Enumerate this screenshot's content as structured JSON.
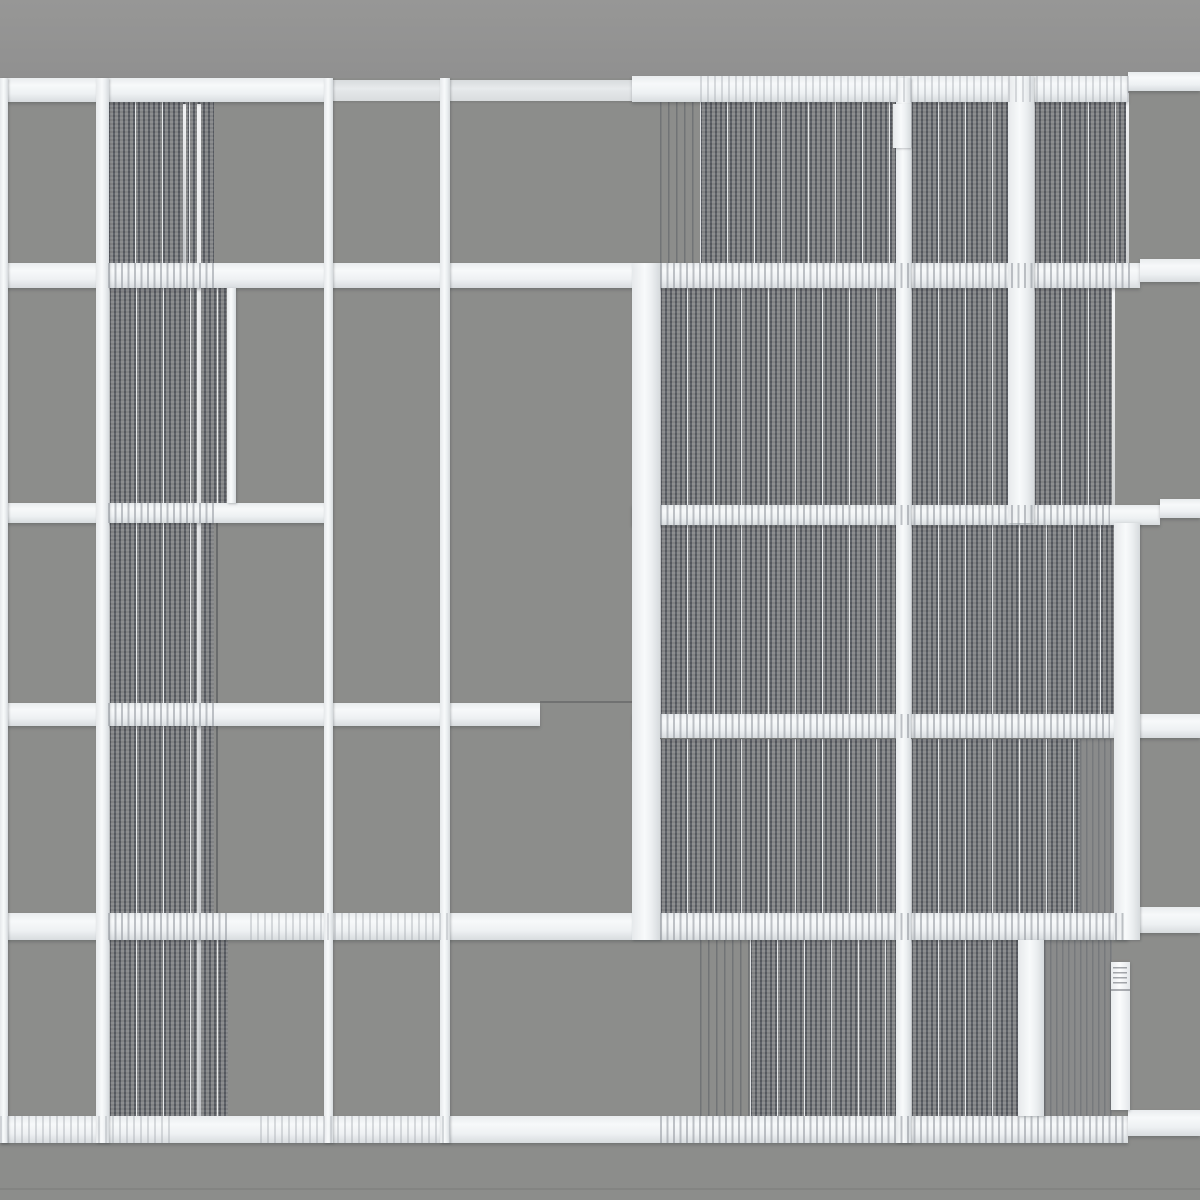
{
  "artwork": {
    "description": "photograph of abstract thread-and-wood wall artwork, no text",
    "canvas": {
      "width": 1200,
      "height": 1200
    },
    "palette": {
      "wall_gray": "#8c8d8b",
      "sky_gray": "#969695",
      "bar_white": "#f7f9fa",
      "bar_shade": "#d8dcdf",
      "thread_dark": "#50545b",
      "thread_mid": "#8c8f94",
      "warp_white": "#f7f9fa",
      "shadow": "#3c3e42"
    },
    "elements": [
      {
        "name": "sky-band",
        "style": "sky",
        "x": 0,
        "y": 0,
        "w": 1200,
        "h": 78
      },
      {
        "name": "panel-r1-left",
        "style": "threads-dense",
        "x": 108,
        "y": 102,
        "w": 106,
        "h": 161
      },
      {
        "name": "panel-r1-mid-sparse",
        "style": "threads-sparse",
        "x": 660,
        "y": 102,
        "w": 42,
        "h": 161
      },
      {
        "name": "panel-r1-mid",
        "style": "threads-dense",
        "x": 700,
        "y": 102,
        "w": 196,
        "h": 161
      },
      {
        "name": "panel-r1-right",
        "style": "threads-dense",
        "x": 911,
        "y": 102,
        "w": 97,
        "h": 161
      },
      {
        "name": "panel-r1-far",
        "style": "threads-dense",
        "x": 1034,
        "y": 102,
        "w": 92,
        "h": 161
      },
      {
        "name": "panel-r2-left",
        "style": "threads-dense",
        "x": 109,
        "y": 288,
        "w": 118,
        "h": 215
      },
      {
        "name": "panel-r2-mid",
        "style": "threads-dense",
        "x": 660,
        "y": 288,
        "w": 236,
        "h": 217
      },
      {
        "name": "panel-r2-right",
        "style": "threads-dense",
        "x": 911,
        "y": 288,
        "w": 97,
        "h": 217
      },
      {
        "name": "panel-r2-far",
        "style": "threads-dense",
        "x": 1034,
        "y": 288,
        "w": 78,
        "h": 217
      },
      {
        "name": "panel-r3-left",
        "style": "threads-dense",
        "x": 109,
        "y": 523,
        "w": 105,
        "h": 180
      },
      {
        "name": "panel-r3-mid",
        "style": "threads-dense",
        "x": 660,
        "y": 523,
        "w": 236,
        "h": 191
      },
      {
        "name": "panel-r3-right",
        "style": "threads-dense",
        "x": 911,
        "y": 523,
        "w": 203,
        "h": 191
      },
      {
        "name": "panel-r4-left",
        "style": "threads-dense",
        "x": 109,
        "y": 726,
        "w": 105,
        "h": 187
      },
      {
        "name": "panel-r4-mid",
        "style": "threads-dense",
        "x": 660,
        "y": 739,
        "w": 236,
        "h": 174
      },
      {
        "name": "panel-r4-right",
        "style": "threads-dense",
        "x": 911,
        "y": 739,
        "w": 169,
        "h": 174
      },
      {
        "name": "panel-r4-far-light",
        "style": "threads-light",
        "x": 1080,
        "y": 739,
        "w": 34,
        "h": 174
      },
      {
        "name": "panel-r5-left",
        "style": "threads-dense",
        "x": 109,
        "y": 940,
        "w": 119,
        "h": 176
      },
      {
        "name": "panel-r5-mid-sparse",
        "style": "threads-sparse",
        "x": 700,
        "y": 940,
        "w": 50,
        "h": 176
      },
      {
        "name": "panel-r5-mid",
        "style": "threads-dense",
        "x": 750,
        "y": 940,
        "w": 146,
        "h": 176
      },
      {
        "name": "panel-r5-right",
        "style": "threads-dense",
        "x": 911,
        "y": 940,
        "w": 107,
        "h": 176
      },
      {
        "name": "panel-r5-far-light",
        "style": "threads-light",
        "x": 1044,
        "y": 940,
        "w": 68,
        "h": 176
      },
      {
        "name": "warp-line-left-panel",
        "style": "warp-line",
        "x": 197,
        "y": 104,
        "w": 4,
        "h": 1012
      },
      {
        "name": "warp-line-row1-left",
        "style": "warp-line",
        "x": 183,
        "y": 104,
        "w": 3,
        "h": 159
      },
      {
        "name": "warp-line-row1-right-edge",
        "style": "warp-line",
        "x": 1126,
        "y": 93,
        "w": 3,
        "h": 172
      },
      {
        "name": "warp-line-row2-right-edge",
        "style": "warp-line",
        "x": 1112,
        "y": 288,
        "w": 3,
        "h": 217
      },
      {
        "name": "dark-thread-line",
        "style": "dark-line",
        "x": 216,
        "y": 523,
        "w": 2,
        "h": 390
      },
      {
        "name": "seam-h4-gap",
        "style": "shadow-seam",
        "x": 540,
        "y": 701,
        "w": 94,
        "h": 2
      },
      {
        "name": "seam-wall-bottom",
        "style": "wall-seam",
        "x": 0,
        "y": 1188,
        "w": 1200,
        "h": 2
      },
      {
        "name": "bar-h1-left",
        "style": "bar-h",
        "x": 0,
        "y": 78,
        "w": 330,
        "h": 24
      },
      {
        "name": "bar-h1-middle",
        "style": "bar-h-dim",
        "x": 330,
        "y": 80,
        "w": 302,
        "h": 21
      },
      {
        "name": "bar-h1-right",
        "style": "bar-h",
        "x": 632,
        "y": 76,
        "w": 496,
        "h": 26
      },
      {
        "name": "bar-h1-end",
        "style": "bar-h",
        "x": 1128,
        "y": 72,
        "w": 72,
        "h": 19
      },
      {
        "name": "bar-h2-main",
        "style": "bar-h",
        "x": 0,
        "y": 263,
        "w": 1140,
        "h": 25
      },
      {
        "name": "bar-h2-end",
        "style": "bar-h",
        "x": 1140,
        "y": 259,
        "w": 60,
        "h": 23
      },
      {
        "name": "bar-h3-left",
        "style": "bar-h",
        "x": 0,
        "y": 503,
        "w": 330,
        "h": 20
      },
      {
        "name": "bar-h3-right",
        "style": "bar-h",
        "x": 632,
        "y": 505,
        "w": 528,
        "h": 20
      },
      {
        "name": "bar-h3-end",
        "style": "bar-h",
        "x": 1160,
        "y": 499,
        "w": 40,
        "h": 19
      },
      {
        "name": "bar-h4-left",
        "style": "bar-h",
        "x": 0,
        "y": 703,
        "w": 540,
        "h": 23
      },
      {
        "name": "bar-h4-right",
        "style": "bar-h",
        "x": 633,
        "y": 714,
        "w": 567,
        "h": 24
      },
      {
        "name": "bar-h5-main",
        "style": "bar-h",
        "x": 0,
        "y": 913,
        "w": 1128,
        "h": 27
      },
      {
        "name": "bar-h5-end",
        "style": "bar-h",
        "x": 1128,
        "y": 907,
        "w": 72,
        "h": 26
      },
      {
        "name": "bar-h6-main",
        "style": "bar-h",
        "x": 0,
        "y": 1116,
        "w": 1128,
        "h": 27
      },
      {
        "name": "bar-h6-end",
        "style": "bar-h",
        "x": 1128,
        "y": 1110,
        "w": 72,
        "h": 26
      },
      {
        "name": "bar-v-left-edge",
        "style": "bar-v",
        "x": 0,
        "y": 78,
        "w": 8,
        "h": 1065
      },
      {
        "name": "bar-v1",
        "style": "bar-v",
        "x": 96,
        "y": 78,
        "w": 13,
        "h": 1065
      },
      {
        "name": "bar-v2",
        "style": "bar-v",
        "x": 324,
        "y": 78,
        "w": 9,
        "h": 1065
      },
      {
        "name": "bar-v3",
        "style": "bar-v",
        "x": 440,
        "y": 78,
        "w": 10,
        "h": 1065
      },
      {
        "name": "bar-v4-wide",
        "style": "bar-v",
        "x": 632,
        "y": 263,
        "w": 28,
        "h": 677
      },
      {
        "name": "bar-v5",
        "style": "bar-v",
        "x": 896,
        "y": 78,
        "w": 15,
        "h": 1065
      },
      {
        "name": "bar-v5-cap",
        "style": "bar-v",
        "x": 893,
        "y": 104,
        "w": 18,
        "h": 44
      },
      {
        "name": "bar-v6-upper",
        "style": "bar-v",
        "x": 1008,
        "y": 76,
        "w": 26,
        "h": 447
      },
      {
        "name": "bar-v6-lower",
        "style": "bar-v",
        "x": 1018,
        "y": 940,
        "w": 26,
        "h": 176
      },
      {
        "name": "bar-v7-wide",
        "style": "bar-v",
        "x": 1114,
        "y": 523,
        "w": 26,
        "h": 417
      },
      {
        "name": "bar-v-short-row2",
        "style": "bar-v",
        "x": 227,
        "y": 288,
        "w": 9,
        "h": 215
      },
      {
        "name": "fringe-h1-right",
        "style": "fringe-soft",
        "x": 700,
        "y": 76,
        "w": 430,
        "h": 26
      },
      {
        "name": "fringe-h2-left",
        "style": "fringe",
        "x": 108,
        "y": 263,
        "w": 106,
        "h": 25
      },
      {
        "name": "fringe-h2-right",
        "style": "fringe",
        "x": 660,
        "y": 263,
        "w": 470,
        "h": 25
      },
      {
        "name": "fringe-h3-left",
        "style": "fringe",
        "x": 108,
        "y": 503,
        "w": 106,
        "h": 20
      },
      {
        "name": "fringe-h3-right",
        "style": "fringe",
        "x": 660,
        "y": 505,
        "w": 450,
        "h": 20
      },
      {
        "name": "fringe-h4-left",
        "style": "fringe",
        "x": 108,
        "y": 703,
        "w": 106,
        "h": 23
      },
      {
        "name": "fringe-h4-right",
        "style": "fringe",
        "x": 660,
        "y": 714,
        "w": 450,
        "h": 24
      },
      {
        "name": "fringe-h5-left",
        "style": "fringe",
        "x": 108,
        "y": 913,
        "w": 120,
        "h": 27
      },
      {
        "name": "fringe-h5-mid",
        "style": "fringe-soft",
        "x": 250,
        "y": 913,
        "w": 200,
        "h": 27
      },
      {
        "name": "fringe-h5-right",
        "style": "fringe",
        "x": 660,
        "y": 913,
        "w": 468,
        "h": 27
      },
      {
        "name": "fringe-h6-a",
        "style": "fringe-soft",
        "x": 0,
        "y": 1116,
        "w": 170,
        "h": 27
      },
      {
        "name": "fringe-h6-b",
        "style": "fringe-soft",
        "x": 260,
        "y": 1116,
        "w": 190,
        "h": 27
      },
      {
        "name": "fringe-h6-c",
        "style": "fringe",
        "x": 660,
        "y": 1116,
        "w": 468,
        "h": 27
      },
      {
        "name": "hang-tag",
        "style": "hang-tag",
        "x": 1111,
        "y": 962,
        "w": 19,
        "h": 148
      }
    ]
  }
}
